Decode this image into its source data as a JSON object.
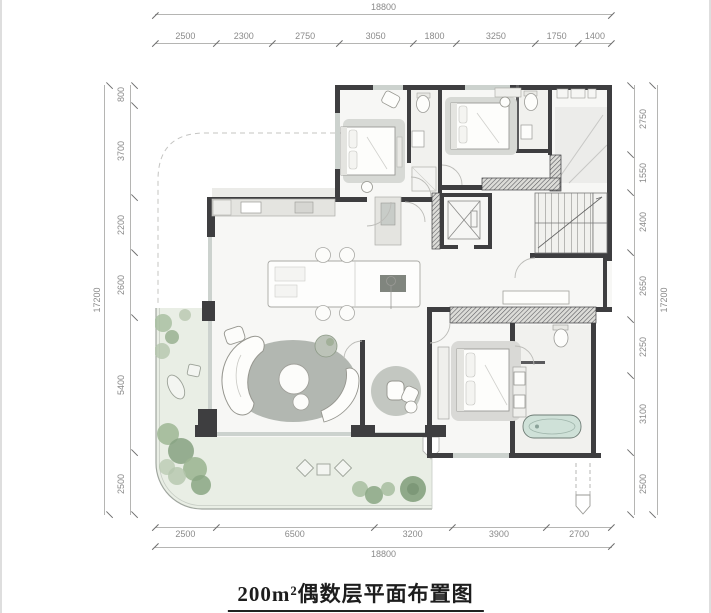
{
  "title": {
    "text": "200m²偶数层平面布置图"
  },
  "dimensions": {
    "top": {
      "total": "18800",
      "segments": [
        "2500",
        "2300",
        "2750",
        "3050",
        "1800",
        "3250",
        "1750",
        "1400"
      ]
    },
    "bottom": {
      "total": "18800",
      "segments": [
        "2500",
        "6500",
        "3200",
        "3900",
        "2700"
      ]
    },
    "left": {
      "total": "17200",
      "segments": [
        "800",
        "3700",
        "2200",
        "2600",
        "5400",
        "2500"
      ]
    },
    "right": {
      "total": "17200",
      "segments": [
        "2750",
        "1550",
        "2400",
        "2650",
        "2250",
        "3100",
        "2500"
      ]
    }
  },
  "plan": {
    "colors": {
      "wall": "#3e3e40",
      "floor": "#f7f7f5",
      "terrace": "#e9eee5",
      "rug": "#b2b7b1",
      "bathtub": "#cfe1d8",
      "plant": "#94ac8c",
      "window": "#ccd2ce"
    },
    "rooms": [
      "bedroom",
      "bathroom",
      "bedroom",
      "bathroom",
      "kitchen",
      "dining",
      "living-room",
      "study-nook",
      "master-bedroom",
      "master-bathroom",
      "elevator",
      "staircase",
      "corridor",
      "terrace"
    ]
  }
}
